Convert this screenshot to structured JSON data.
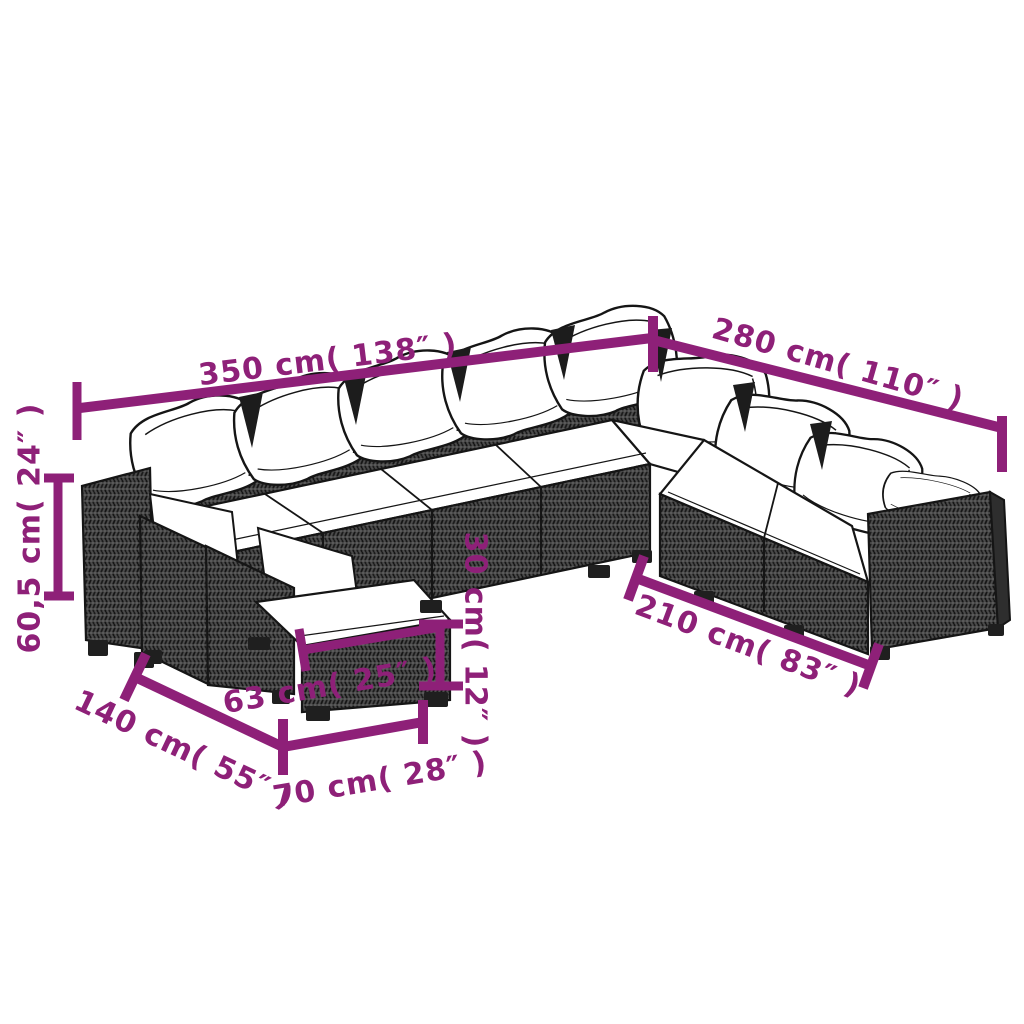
{
  "colors": {
    "accent": "#8E2078",
    "ink": "#151515",
    "cushion": "#ffffff",
    "rattan": "#4b4b4b",
    "background": "#ffffff"
  },
  "dims": {
    "d350": {
      "label": "350 cm( 138″ )",
      "cm": "350",
      "inch": "138″"
    },
    "d280": {
      "label": "280 cm( 110″ )",
      "cm": "280",
      "inch": "110″"
    },
    "d605": {
      "label": "60,5 cm( 24″ )",
      "cm": "60,5",
      "inch": "24″"
    },
    "d30": {
      "label": "30 cm( 12″ )",
      "cm": "30",
      "inch": "12″"
    },
    "d210": {
      "label": "210 cm( 83″ )",
      "cm": "210",
      "inch": "83″"
    },
    "d63": {
      "label": "63 cm( 25″ )",
      "cm": "63",
      "inch": "25″"
    },
    "d140": {
      "label": "140 cm( 55″ )",
      "cm": "140",
      "inch": "55″"
    },
    "d70": {
      "label": "70 cm( 28″ )",
      "cm": "70",
      "inch": "28″"
    }
  }
}
